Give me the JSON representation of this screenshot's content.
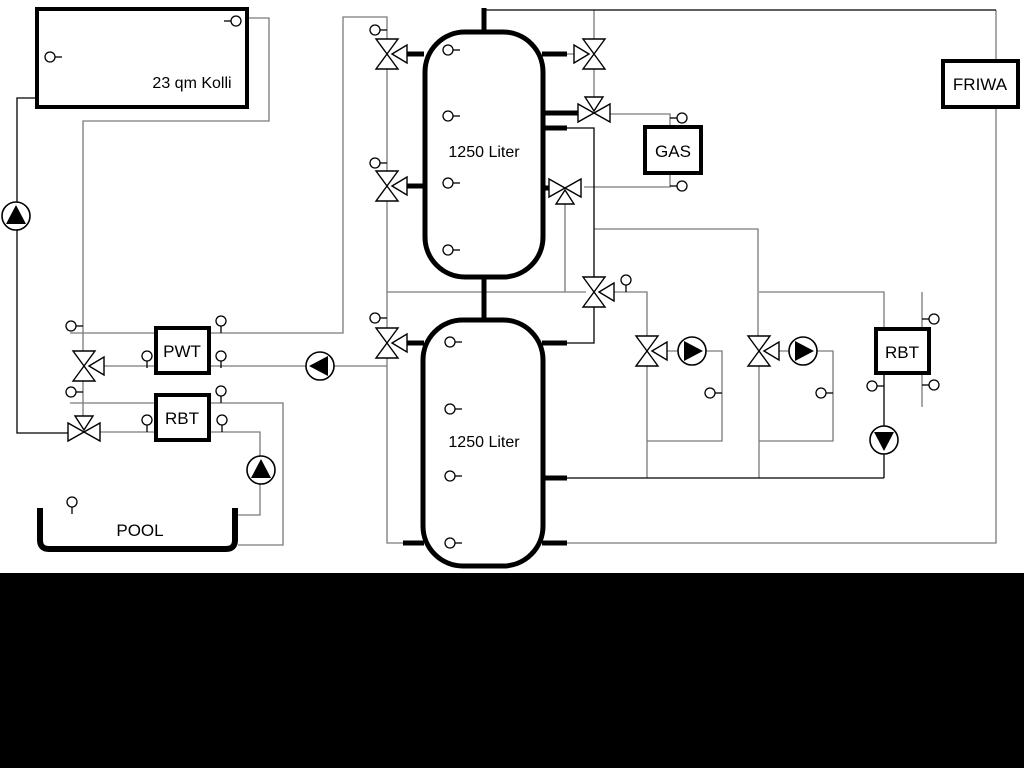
{
  "schematic": {
    "labels": {
      "collector": "23 qm Kolli",
      "buffer_tank_top": "1250 Liter",
      "buffer_tank_bottom": "1250 Liter",
      "pwt": "PWT",
      "rbt_left": "RBT",
      "gas": "GAS",
      "friwa": "FRIWA",
      "rbt_right": "RBT",
      "pool": "POOL"
    },
    "colors": {
      "pipe_gray": "#7a7a7a",
      "line_black": "#000000",
      "background": "#ffffff",
      "bottom_band": "#000000"
    }
  }
}
